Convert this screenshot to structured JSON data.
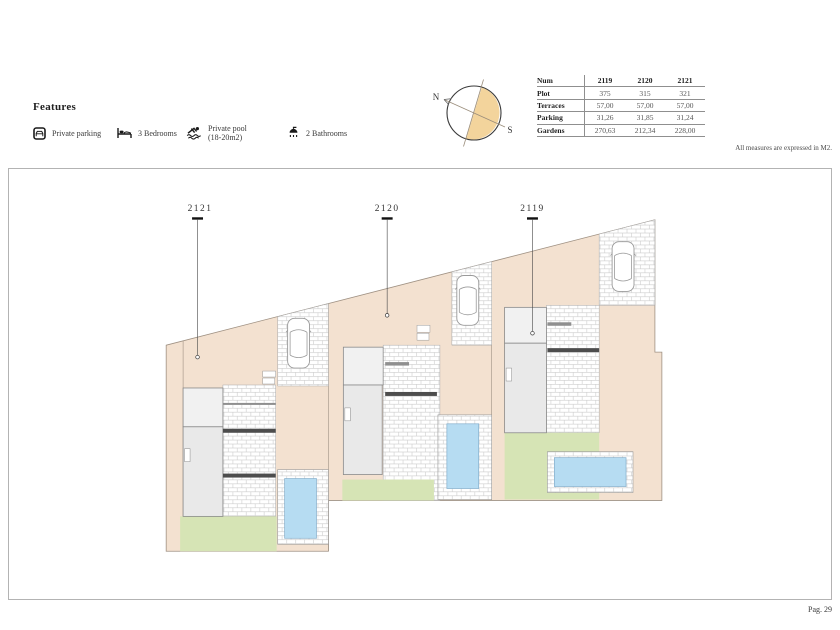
{
  "features": {
    "title": "Features",
    "items": [
      {
        "icon": "parking-icon",
        "label": "Private parking"
      },
      {
        "icon": "bed-icon",
        "label": "3 Bedrooms"
      },
      {
        "icon": "pool-icon",
        "label": "Private pool",
        "label2": "(18-20m2)"
      },
      {
        "icon": "shower-icon",
        "label": "2 Bathrooms"
      }
    ]
  },
  "compass": {
    "north": "N",
    "south": "S"
  },
  "site_table": {
    "header_label": "Num",
    "columns": [
      "2119",
      "2120",
      "2121"
    ],
    "rows": [
      {
        "label": "Plot",
        "values": [
          "375",
          "315",
          "321"
        ]
      },
      {
        "label": "Terraces",
        "values": [
          "57,00",
          "57,00",
          "57,00"
        ]
      },
      {
        "label": "Parking",
        "values": [
          "31,26",
          "31,85",
          "31,24"
        ]
      },
      {
        "label": "Gardens",
        "values": [
          "270,63",
          "212,34",
          "228,00"
        ]
      }
    ],
    "note": "All measures are expressed in M2."
  },
  "plan": {
    "plots": [
      {
        "label": "2121"
      },
      {
        "label": "2120"
      },
      {
        "label": "2119"
      }
    ],
    "colors": {
      "ground": "#f3e1d0",
      "garden": "#d6e4b5",
      "pool": "#b6dcf2",
      "building": "#e9e9e9",
      "compass_fill": "#f3d49c"
    }
  },
  "footer": {
    "page_label": "Pag. 29"
  }
}
